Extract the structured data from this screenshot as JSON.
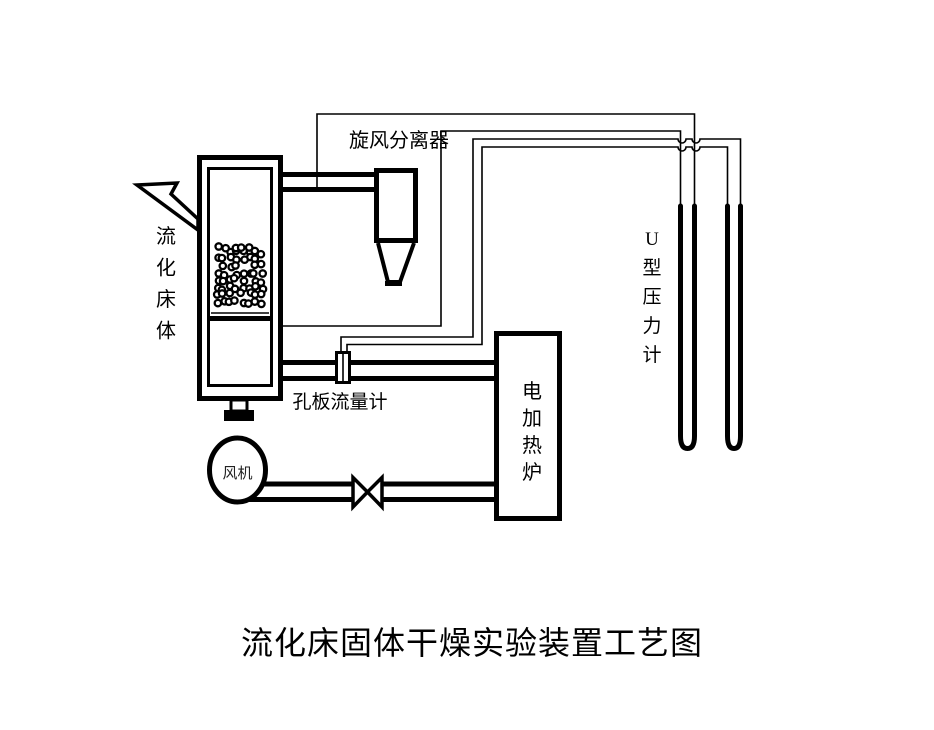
{
  "diagram": {
    "title": "流化床固体干燥实验装置工艺图",
    "components": [
      {
        "id": "fluidized-bed",
        "label": "流化床体"
      },
      {
        "id": "cyclone-separator",
        "label": "旋风分离器"
      },
      {
        "id": "orifice-flowmeter",
        "label": "孔板流量计"
      },
      {
        "id": "electric-heater",
        "label": "电加热炉"
      },
      {
        "id": "fan",
        "label": "风机"
      },
      {
        "id": "u-tube-manometer",
        "label": "U型压力计"
      }
    ],
    "colors": {
      "line": "#000000",
      "background": "#ffffff"
    }
  }
}
